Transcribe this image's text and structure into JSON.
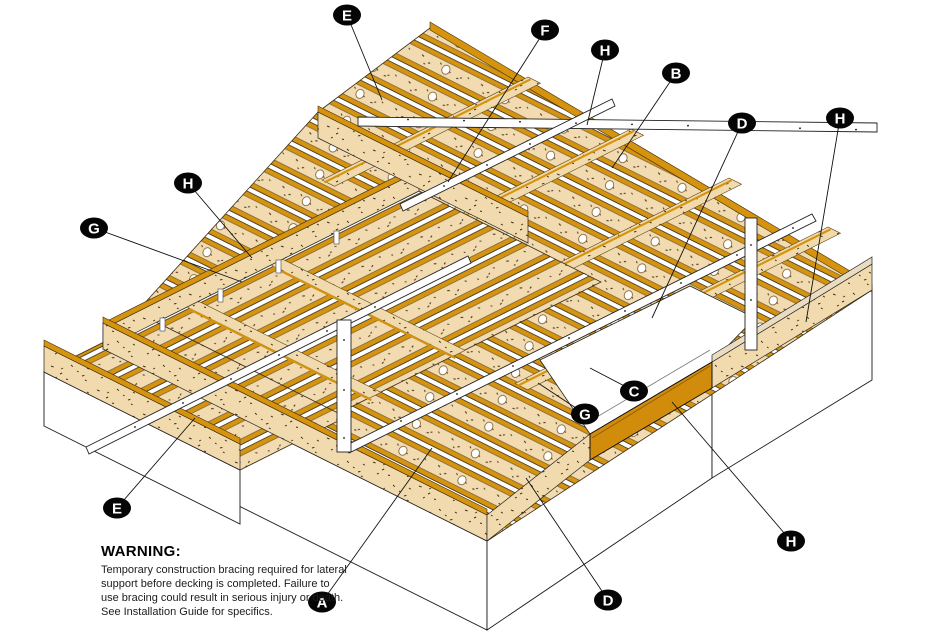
{
  "callouts": [
    {
      "letter": "E"
    },
    {
      "letter": "F"
    },
    {
      "letter": "H"
    },
    {
      "letter": "B"
    },
    {
      "letter": "D"
    },
    {
      "letter": "H"
    },
    {
      "letter": "H"
    },
    {
      "letter": "G"
    },
    {
      "letter": "E"
    },
    {
      "letter": "A"
    },
    {
      "letter": "D"
    },
    {
      "letter": "G"
    },
    {
      "letter": "C"
    },
    {
      "letter": "H"
    }
  ],
  "warning": {
    "title": "WARNING:",
    "lines": [
      "Temporary construction bracing required for lateral",
      "support before decking is completed. Failure to",
      "use bracing could result in serious injury or death.",
      "See Installation Guide for specifics."
    ]
  },
  "colors": {
    "background": "#FFFFFF",
    "joist_web_tan": "#F2DBB0",
    "joist_flange_orange": "#D6940E",
    "highlight_rim": "#D28C0C",
    "outline": "#3A2C10",
    "badge": "#050505"
  }
}
